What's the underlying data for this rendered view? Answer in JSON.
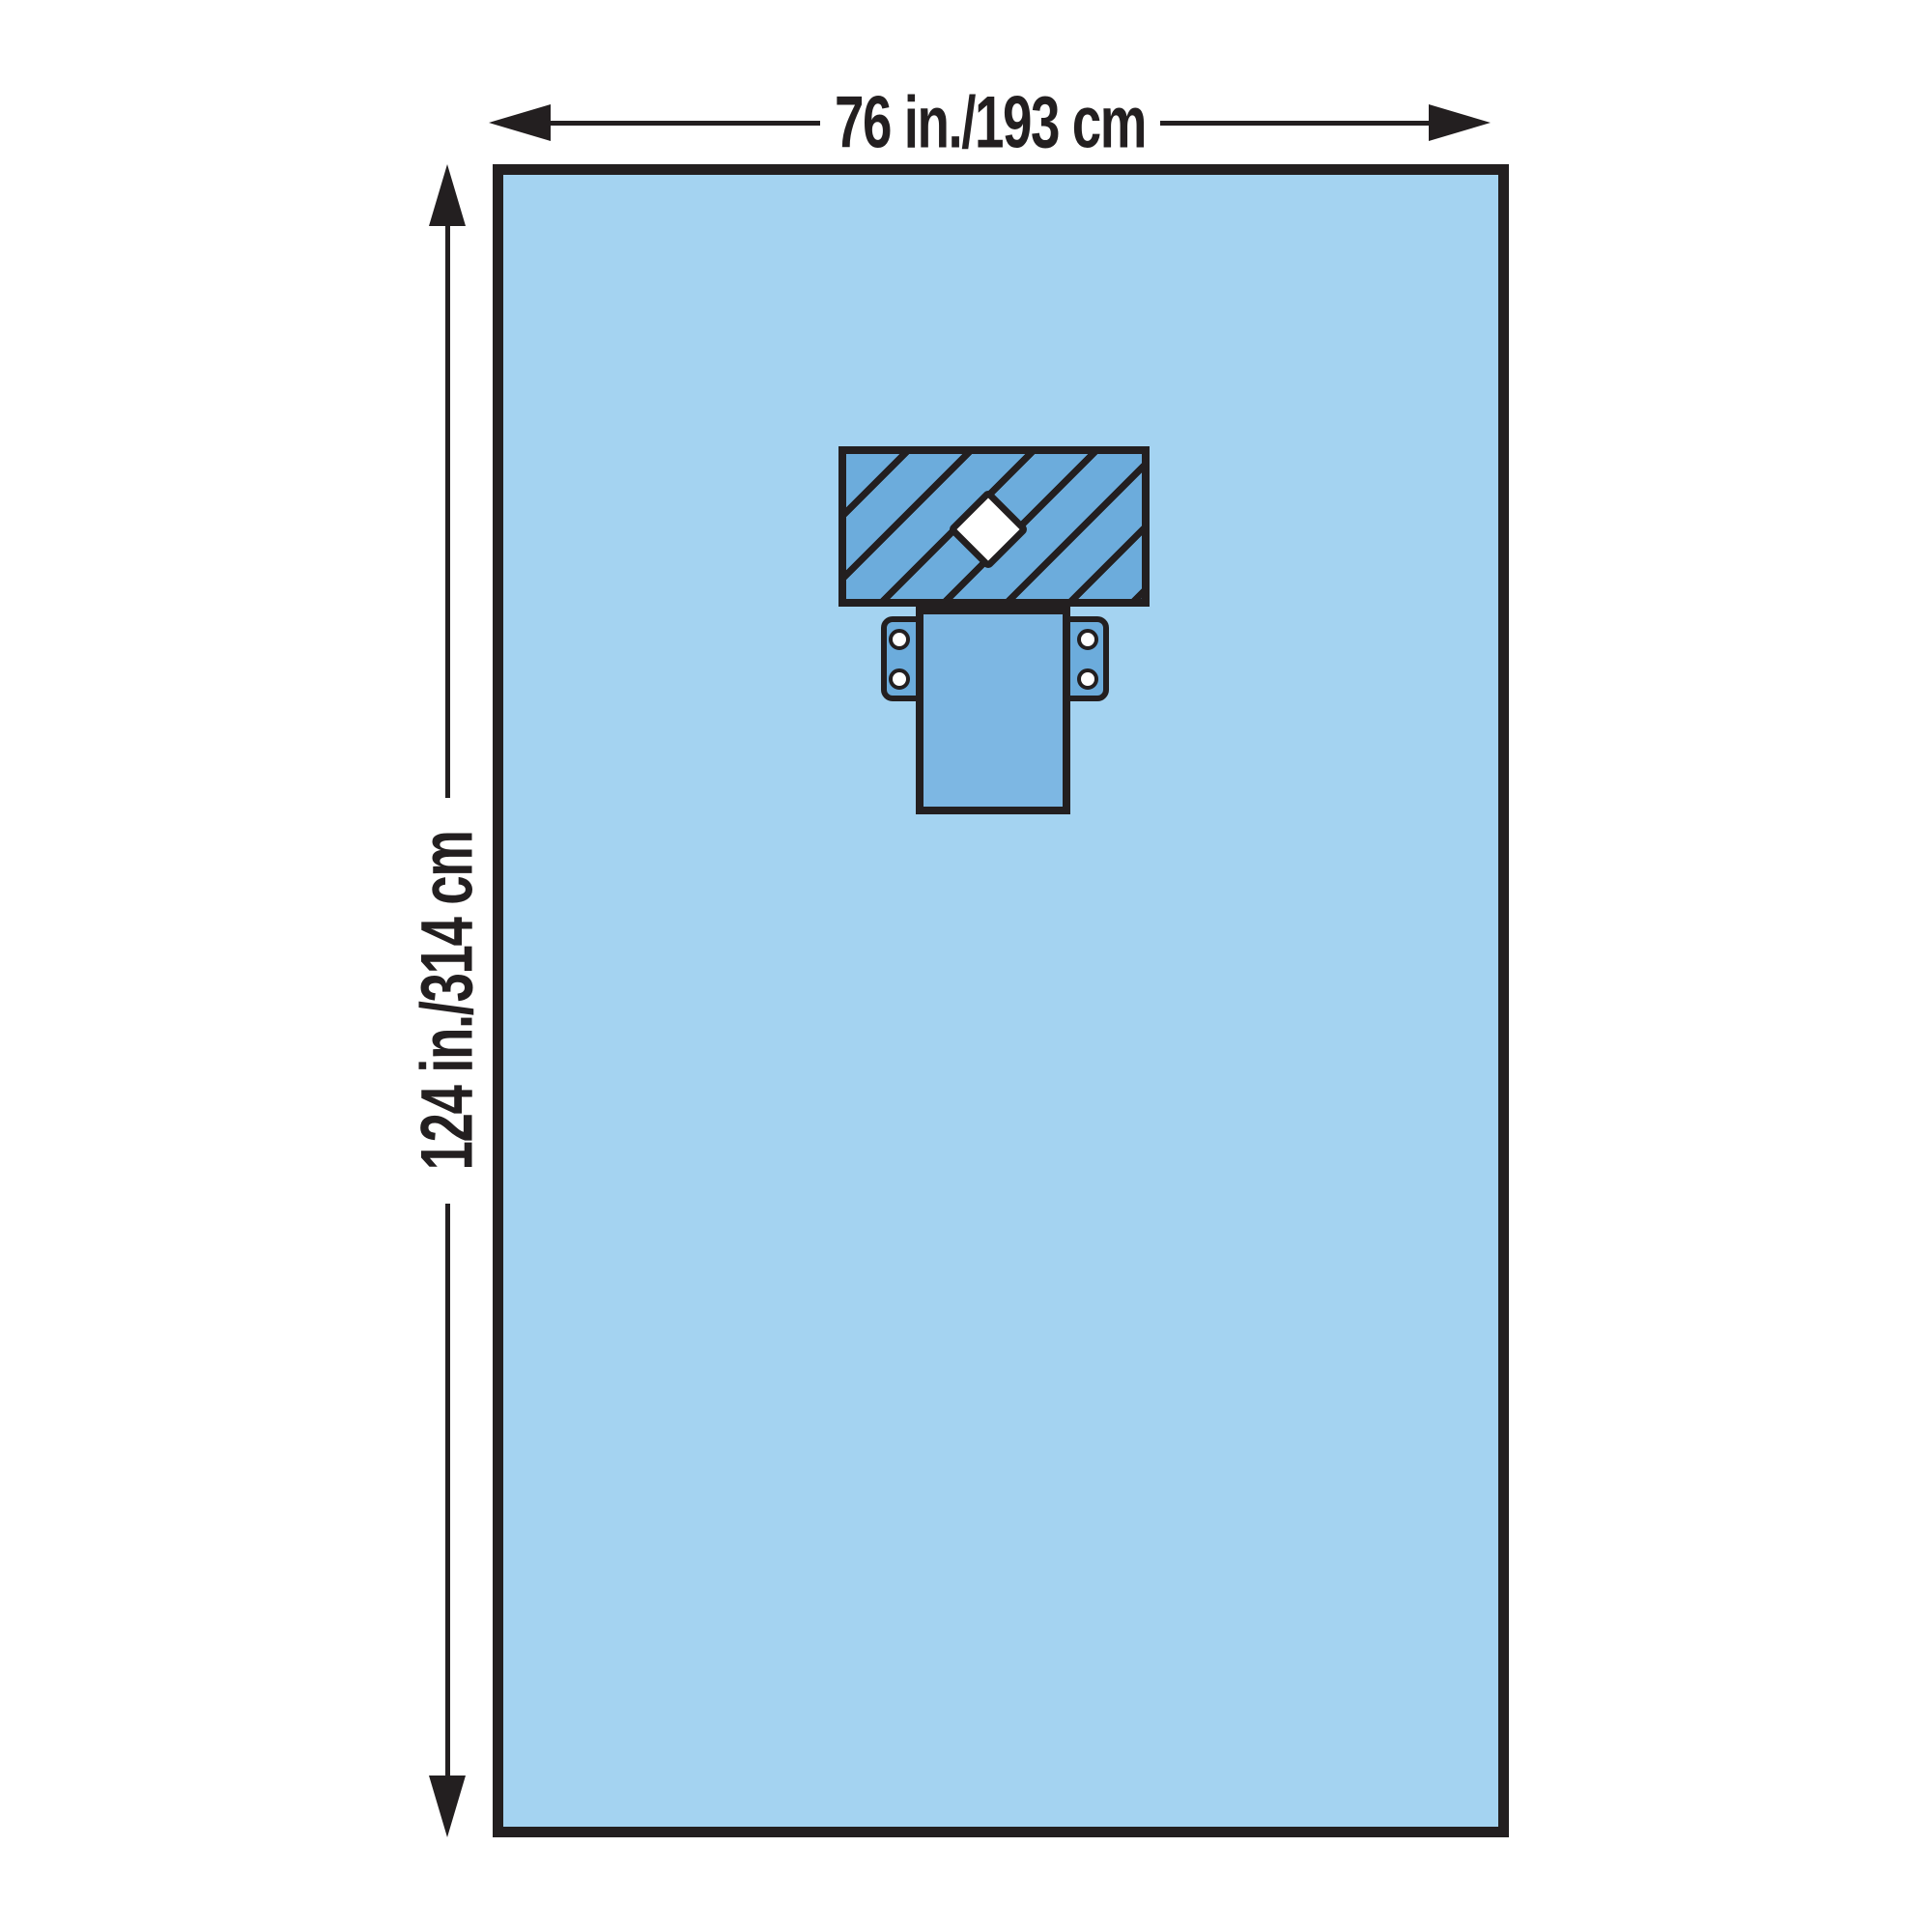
{
  "dimensions": {
    "width_label": "76 in./193 cm",
    "height_label": "124 in./314 cm"
  },
  "colors": {
    "background": "#ffffff",
    "drape_fill": "#a4d3f1",
    "patch_fill": "#6cacdc",
    "panel_fill": "#7db7e3",
    "outline": "#231f20",
    "fenestration_fill": "#ffffff",
    "snap_fill": "#ffffff"
  }
}
